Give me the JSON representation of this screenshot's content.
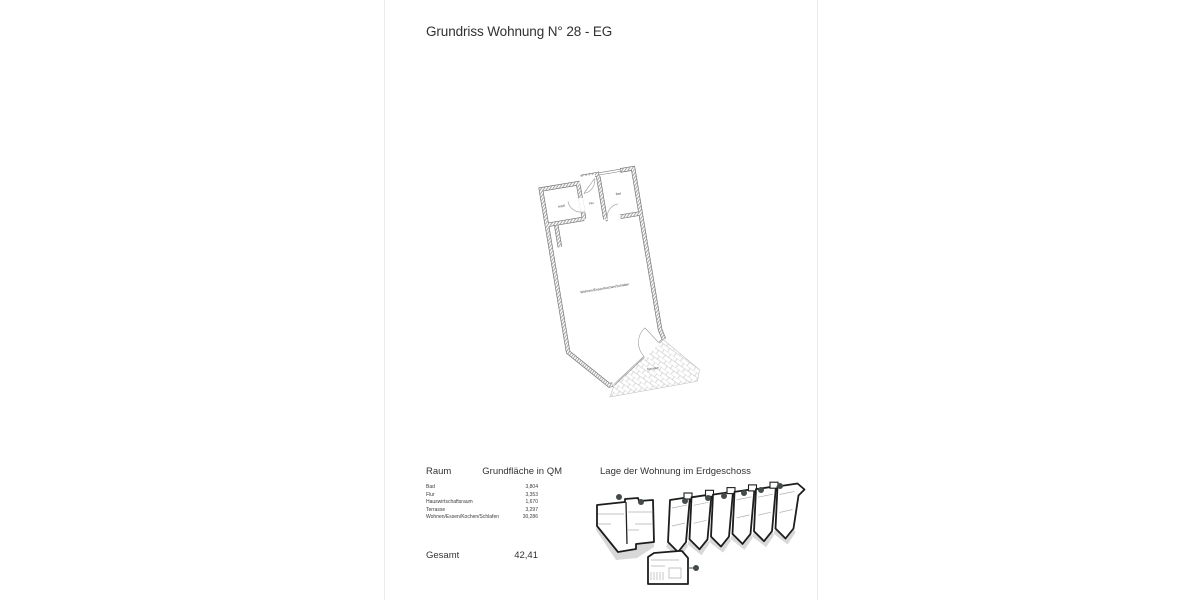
{
  "page": {
    "title": "Grundriss Wohnung N° 28 - EG"
  },
  "floor_plan": {
    "labels": {
      "hwr": "HWR",
      "flur": "Flur",
      "bad": "Bad",
      "living": "Wohnen/Essen/Kochen/Schlafen",
      "terrasse": "Terrasse"
    }
  },
  "area_table": {
    "col_room": "Raum",
    "col_area": "Grundfläche in QM",
    "rows": [
      {
        "room": "Bad",
        "area": "3,804"
      },
      {
        "room": "Flur",
        "area": "3,353"
      },
      {
        "room": "Hauswirtschaftsraum",
        "area": "1,670"
      },
      {
        "room": "Terrasse",
        "area": "3,297"
      },
      {
        "room": "Wohnen/Essen/Kochen/Schlafen",
        "area": "30,286"
      }
    ],
    "total_label": "Gesamt",
    "total_value": "42,41"
  },
  "location": {
    "title": "Lage der Wohnung im Erdgeschoss",
    "highlight_color": "#6f9a70"
  }
}
